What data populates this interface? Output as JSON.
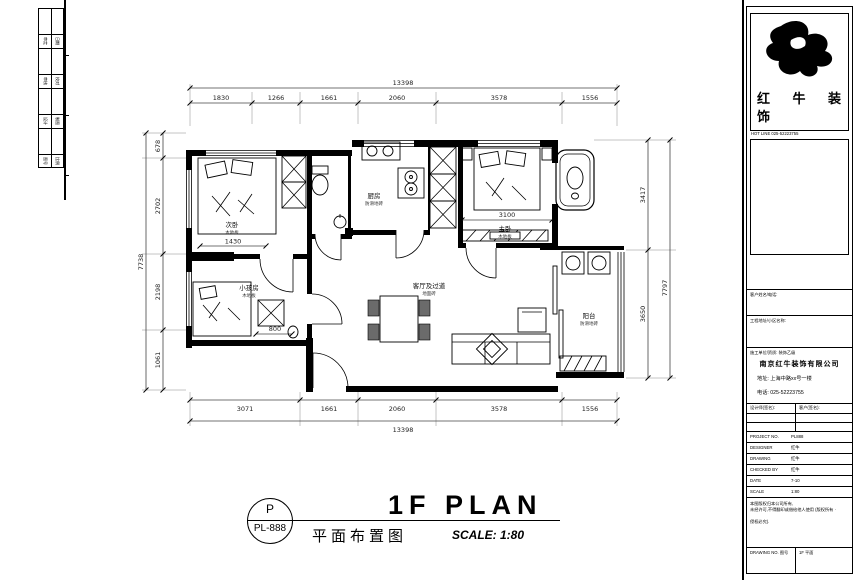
{
  "strip": {
    "rows": [
      [
        "审定",
        "日期"
      ],
      [
        "审核",
        "校对"
      ],
      [
        "设计",
        "制图"
      ],
      [
        "图号",
        "比例"
      ]
    ]
  },
  "plan": {
    "rooms": {
      "bedroom2": {
        "name": "次卧",
        "sub": "木地板"
      },
      "kids": {
        "name": "小孩房",
        "sub": "木地板"
      },
      "kitchen": {
        "name": "厨房",
        "sub": "防滑地砖"
      },
      "master": {
        "name": "主卧",
        "sub": "木地板"
      },
      "living": {
        "name": "客厅及过道",
        "sub": "地面砖"
      },
      "balcony": {
        "name": "阳台",
        "sub": "防滑地砖"
      }
    },
    "dims": {
      "top_total": "13398",
      "top": [
        "1830",
        "1266",
        "1661",
        "2060",
        "3578",
        "1556"
      ],
      "bottom": [
        "3071",
        "1661",
        "2060",
        "3578",
        "1556"
      ],
      "bottom_total": "13398",
      "left": [
        "678",
        "2702",
        "2198",
        "1061"
      ],
      "left_total": "7738",
      "right": [
        "3417",
        "3650"
      ],
      "right_total": "7797",
      "master_bed": "3100",
      "bed2": "1430",
      "kids_desk": "800"
    }
  },
  "titleblock": {
    "brand_l1": "红 牛 装",
    "brand_l2": "饰",
    "hotline": "HOT LINE 025-52223755",
    "row1": "客户姓名/电话:",
    "row2": "工程地址/小区名称:",
    "company_header": "施工单位/资质: 装饰乙级",
    "company_name": "南京红牛装饰有限公司",
    "company_addr": "地址: 上海中路xx号一楼",
    "company_tel": "电话: 025-52223755",
    "sign_left": "设计师(签名):",
    "sign_right": "客户(签名):",
    "fields": [
      {
        "label": "PROJECT NO.",
        "value": "PL888"
      },
      {
        "label": "DESIGNER",
        "value": "红牛"
      },
      {
        "label": "DRAWING",
        "value": "红牛"
      },
      {
        "label": "CHECKED BY",
        "value": "红牛"
      },
      {
        "label": "DATE",
        "value": "7-10"
      },
      {
        "label": "SCALE",
        "value": "1:80"
      }
    ],
    "note1": "本图版权归本公司所有,",
    "note2": "未经许可,不得翻印或借给他人使用 (版权所有 ·",
    "note3": "侵权必究).",
    "bottom_left": "DRAWING NO. 图号",
    "bottom_right": "1F 平面"
  },
  "title": {
    "circle_top": "P",
    "circle_bottom": "PL-888",
    "main": "1F PLAN",
    "cn": "平面布置图",
    "scale": "SCALE: 1:80"
  }
}
